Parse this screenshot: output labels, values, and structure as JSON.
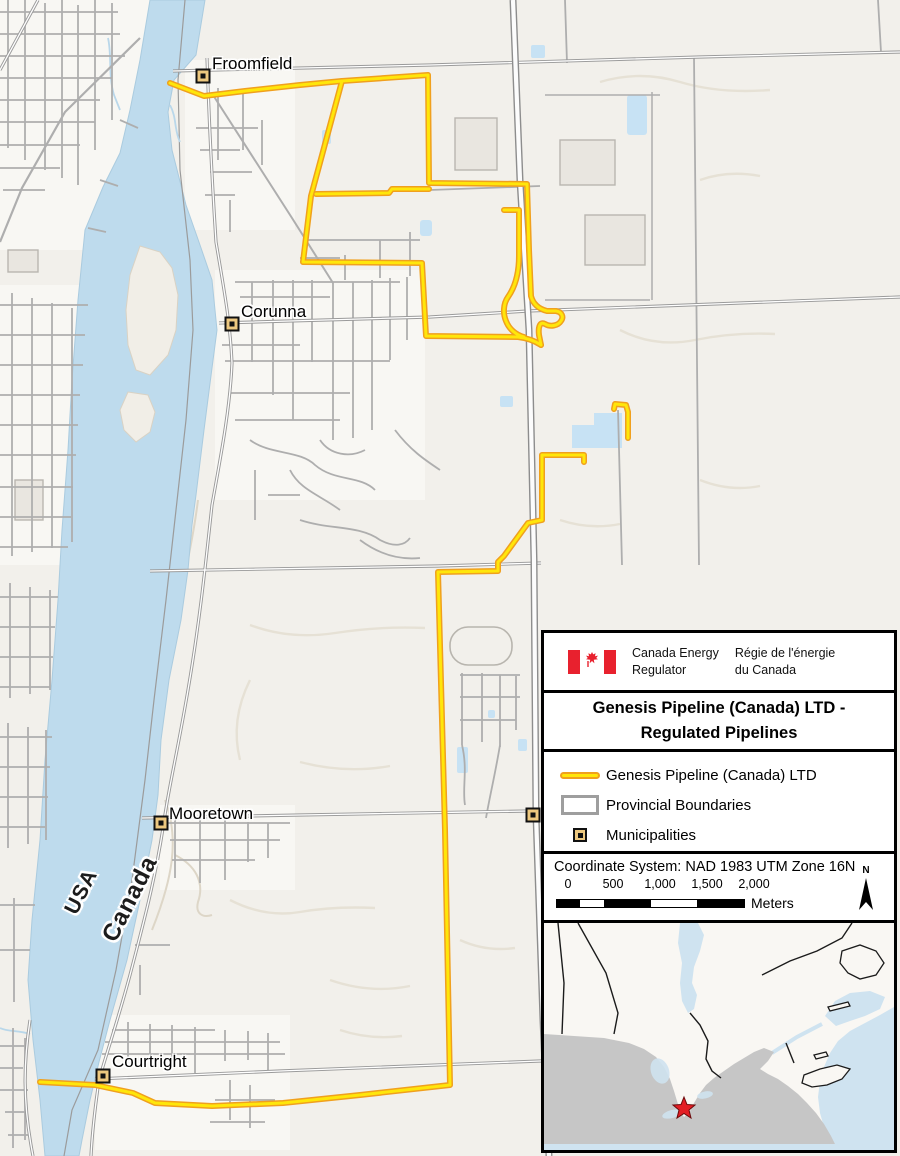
{
  "map": {
    "labels": {
      "froomfield": "Froomfield",
      "corunna": "Corunna",
      "mooretown": "Mooretown",
      "courtright": "Courtright",
      "usa": "USA",
      "canada": "Canada"
    }
  },
  "legend": {
    "agency": {
      "en_line1": "Canada Energy",
      "en_line2": "Regulator",
      "fr_line1": "Régie de l'énergie",
      "fr_line2": "du Canada"
    },
    "title_line1": "Genesis Pipeline (Canada) LTD -",
    "title_line2": "Regulated Pipelines",
    "items": [
      {
        "label": "Genesis Pipeline (Canada) LTD"
      },
      {
        "label": "Provincial Boundaries"
      },
      {
        "label": "Municipalities"
      }
    ],
    "coordinate_system": "Coordinate System: NAD 1983 UTM Zone 16N",
    "scale": {
      "ticks": [
        "0",
        "500",
        "1,000",
        "1,500",
        "2,000"
      ],
      "unit": "Meters"
    },
    "north_label": "N"
  },
  "colors": {
    "land": "#f2f0eb",
    "water": "#bedbed",
    "pipeline_core": "#ffe60a",
    "pipeline_casing": "#f0a01e",
    "road_gray": "#aeaeae",
    "municipality_fill": "#edc87f",
    "flag_red": "#e8212e",
    "inset_usa_gray": "#c6c6c6",
    "star_red": "#e31e24"
  }
}
